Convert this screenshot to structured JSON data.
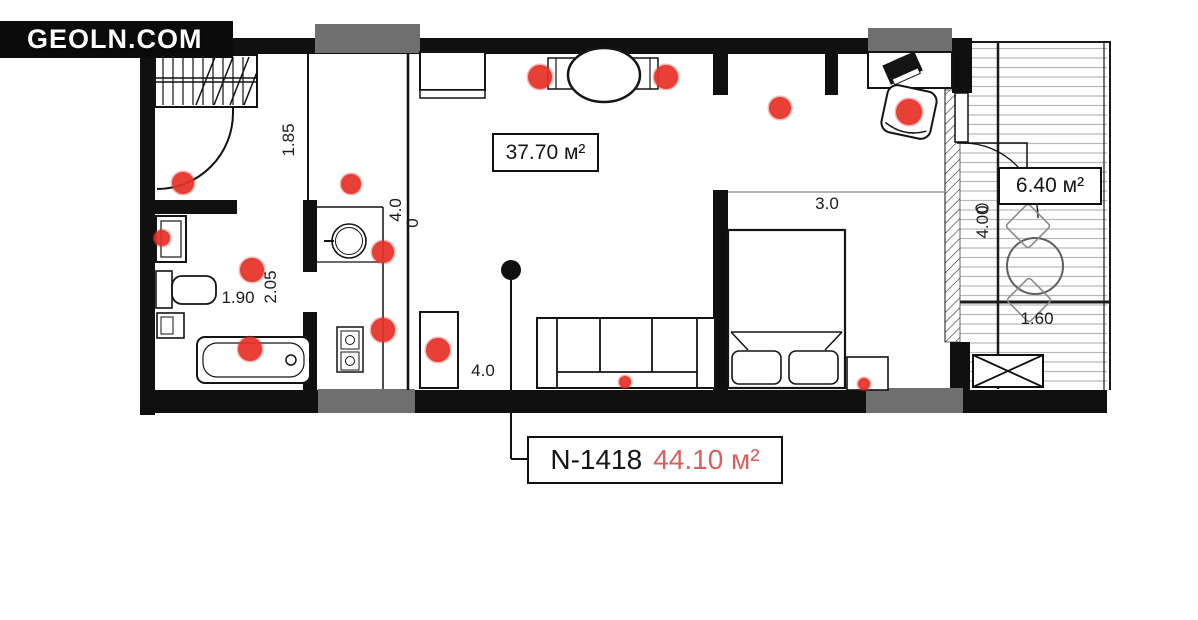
{
  "logo": {
    "text": "GEOLN.COM"
  },
  "plan": {
    "unit": {
      "number": "N-1418",
      "area": "44.10 м²"
    },
    "rooms": [
      {
        "id": "living-kitchen",
        "area_label": "37.70 м²"
      },
      {
        "id": "balcony",
        "area_label": "6.40 м²"
      }
    ],
    "dimensions": [
      {
        "text": "1.85",
        "x": 289,
        "y": 140,
        "rotate": -90
      },
      {
        "text": "4.0",
        "x": 396,
        "y": 210,
        "rotate": -90
      },
      {
        "text": "0",
        "x": 413,
        "y": 223,
        "rotate": -90
      },
      {
        "text": "1.90",
        "x": 238,
        "y": 298,
        "rotate": 0
      },
      {
        "text": "2.05",
        "x": 271,
        "y": 287,
        "rotate": -90
      },
      {
        "text": "4.0",
        "x": 483,
        "y": 371,
        "rotate": 0
      },
      {
        "text": "3.0",
        "x": 827,
        "y": 204,
        "rotate": 0
      },
      {
        "text": "4.00",
        "x": 983,
        "y": 222,
        "rotate": -90
      },
      {
        "text": "1.60",
        "x": 1037,
        "y": 319,
        "rotate": 0
      }
    ],
    "markers": {
      "dots": [
        {
          "x": 183,
          "y": 183,
          "r": 11
        },
        {
          "x": 351,
          "y": 184,
          "r": 10
        },
        {
          "x": 162,
          "y": 238,
          "r": 8
        },
        {
          "x": 252,
          "y": 270,
          "r": 12
        },
        {
          "x": 250,
          "y": 349,
          "r": 12
        },
        {
          "x": 383,
          "y": 252,
          "r": 11
        },
        {
          "x": 383,
          "y": 330,
          "r": 12
        },
        {
          "x": 438,
          "y": 350,
          "r": 12
        },
        {
          "x": 540,
          "y": 77,
          "r": 12
        },
        {
          "x": 666,
          "y": 77,
          "r": 12
        },
        {
          "x": 780,
          "y": 108,
          "r": 11
        },
        {
          "x": 909,
          "y": 112,
          "r": 13
        },
        {
          "x": 625,
          "y": 382,
          "r": 6
        },
        {
          "x": 864,
          "y": 384,
          "r": 6
        }
      ],
      "leader_dot": {
        "x": 511,
        "y": 270,
        "r": 10
      }
    }
  },
  "colors": {
    "marker_red": "#e63228",
    "area_red": "#d95f5c",
    "wall_black": "#101010",
    "window_gray": "#6f6f6f"
  }
}
